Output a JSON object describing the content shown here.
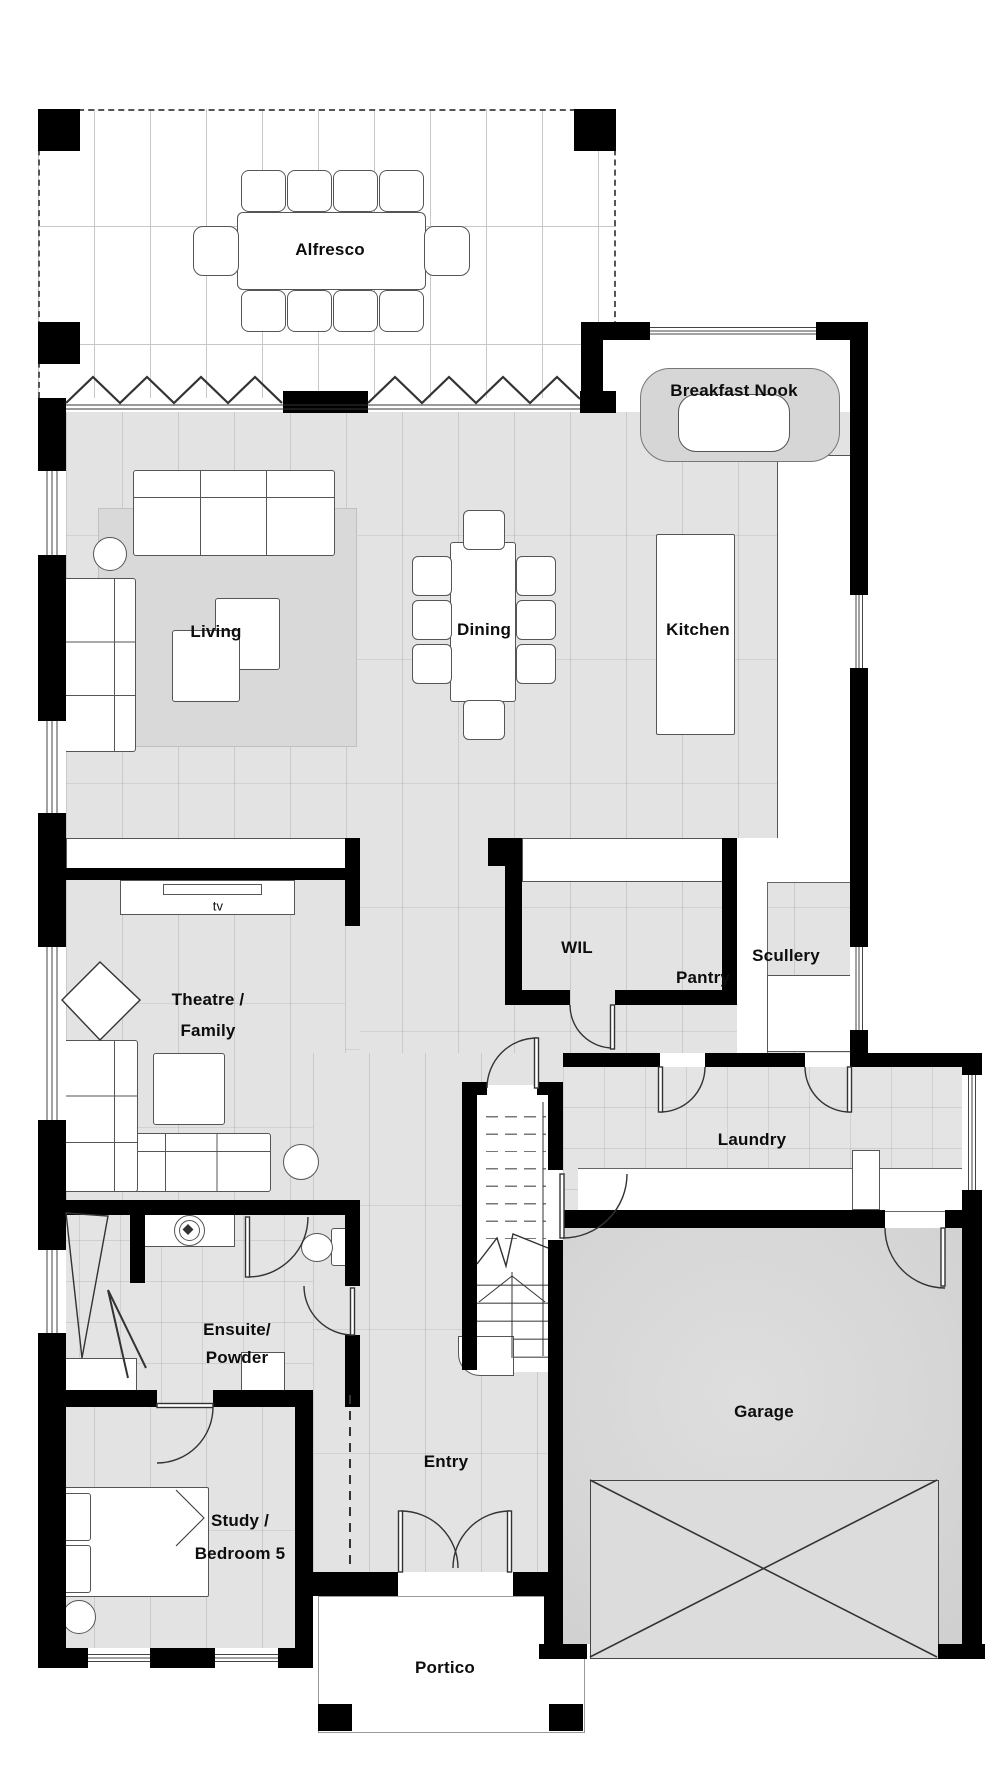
{
  "rooms": {
    "alfresco": "Alfresco",
    "breakfast_nook": "Breakfast Nook",
    "living": "Living",
    "dining": "Dining",
    "kitchen": "Kitchen",
    "wil": "WIL",
    "pantry": "Pantry",
    "scullery": "Scullery",
    "theatre_line1": "Theatre /",
    "theatre_line2": "Family",
    "laundry": "Laundry",
    "ensuite_line1": "Ensuite/",
    "ensuite_line2": "Powder",
    "entry": "Entry",
    "garage": "Garage",
    "study_line1": "Study /",
    "study_line2": "Bedroom 5",
    "portico": "Portico"
  },
  "furniture": {
    "tv_label": "tv"
  },
  "colors": {
    "wall": "#000000",
    "floor_gray": "#e3e3e3",
    "bench_gray": "#d6d6d6",
    "garage_floor": "#d6d6d6",
    "rug_gray": "#d9d9d9",
    "line": "#333333"
  }
}
